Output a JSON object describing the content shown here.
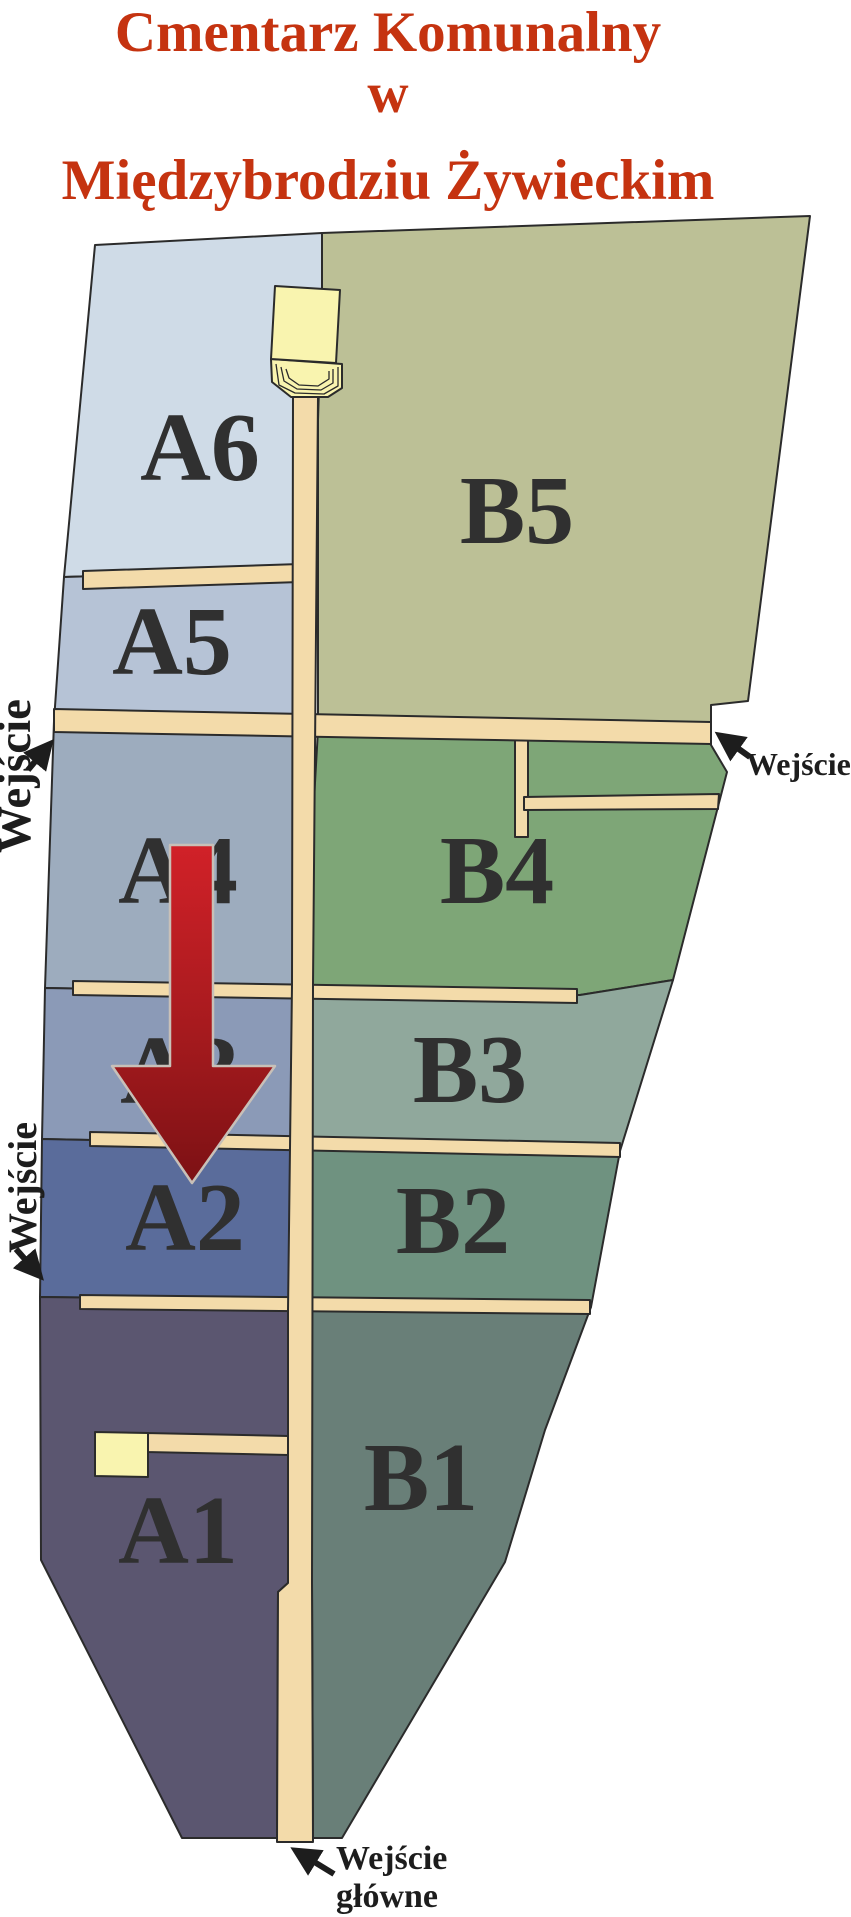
{
  "title": {
    "line1": "Cmentarz Komunalny",
    "line2": "w",
    "line3": "Międzybrodziu Żywieckim"
  },
  "sections": {
    "a1": {
      "label": "A1"
    },
    "a2": {
      "label": "A2"
    },
    "a3": {
      "label": "A3"
    },
    "a4": {
      "label": "A4"
    },
    "a5": {
      "label": "A5"
    },
    "a6": {
      "label": "A6"
    },
    "b1": {
      "label": "B1"
    },
    "b2": {
      "label": "B2"
    },
    "b3": {
      "label": "B3"
    },
    "b4": {
      "label": "B4"
    },
    "b5": {
      "label": "B5"
    }
  },
  "entrances": {
    "side_upper_left": {
      "label": "Wejście"
    },
    "side_lower_left": {
      "label": "Wejście"
    },
    "side_right": {
      "label": "Wejście"
    },
    "main": {
      "label_line1": "Wejście",
      "label_line2": "główne"
    }
  },
  "colors": {
    "title": "#c53310",
    "label": "#303030",
    "entrance_text": "#1d1d1d",
    "a6": "#cfdbe7",
    "a5": "#b6c3d6",
    "a4": "#9dacbe",
    "a3": "#8b9ab7",
    "a2": "#5a6c9b",
    "a1": "#5b5670",
    "b5": "#bcc096",
    "b4": "#7ea677",
    "b3": "#90a89c",
    "b2": "#6f9280",
    "b1": "#697f78",
    "walkway": "#f3dbaa",
    "building": "#f9f4af",
    "arrow_top": "#d12128",
    "arrow_mid": "#a61a1e",
    "arrow_bottom": "#7c1114"
  }
}
